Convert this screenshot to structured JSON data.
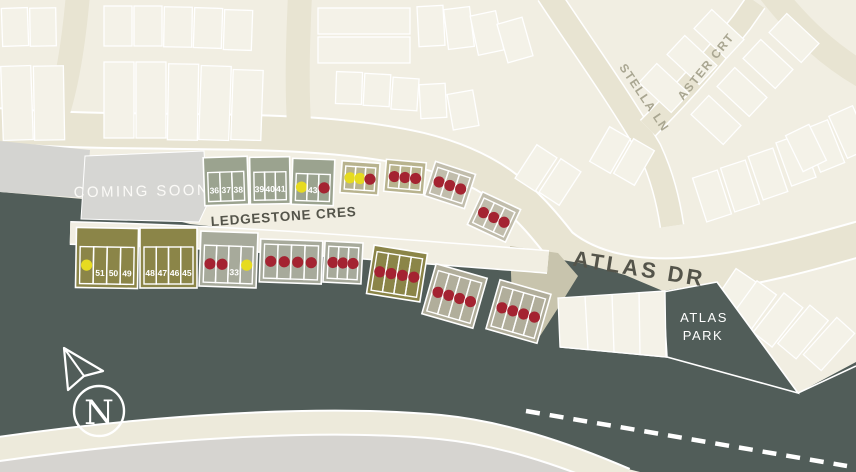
{
  "map": {
    "coming_soon_label": "COMING SOON",
    "streets": {
      "ledgestone": "LEDGESTONE CRES",
      "atlas_dr": "ATLAS DR",
      "stella_ln": "STELLA LN",
      "aster_crt": "ASTER CRT"
    },
    "park": {
      "line1": "ATLAS",
      "line2": "PARK"
    },
    "compass_label": "N",
    "status_colors": {
      "sold": "#a42331",
      "available": "#e6db21"
    },
    "palette": {
      "sage": "#9ba38f",
      "sage2": "#a7aa9b",
      "khaki": "#b8b38e",
      "graytan": "#c1bdac",
      "olive": "#8b8548",
      "sagetan": "#b1ae9b"
    },
    "blocks": [
      {
        "id": "lots-36-38",
        "fill": "sage",
        "x": 204,
        "y": 157,
        "w": 44,
        "h": 48,
        "rot": -2,
        "tp": 15,
        "lots": [
          {
            "num": "36"
          },
          {
            "num": "37"
          },
          {
            "num": "38"
          }
        ]
      },
      {
        "id": "lots-39-41",
        "fill": "sage",
        "x": 250,
        "y": 157,
        "w": 40,
        "h": 47,
        "rot": -1,
        "tp": 15,
        "lots": [
          {
            "num": "39"
          },
          {
            "num": "40"
          },
          {
            "num": "41"
          }
        ]
      },
      {
        "id": "lots-42-44",
        "fill": "sage",
        "x": 292,
        "y": 159,
        "w": 42,
        "h": 46,
        "rot": 2,
        "tp": 15,
        "lots": [
          {
            "status": "available"
          },
          {
            "num": "43"
          },
          {
            "status": "sold"
          }
        ]
      },
      {
        "id": "lots-row1-4",
        "fill": "khaki",
        "x": 341,
        "y": 162,
        "w": 38,
        "h": 32,
        "rot": 4,
        "tp": 5,
        "lots": [
          {
            "status": "available"
          },
          {
            "status": "available"
          },
          {
            "status": "sold"
          }
        ]
      },
      {
        "id": "lots-row1-5",
        "fill": "khaki",
        "x": 385,
        "y": 161,
        "w": 40,
        "h": 32,
        "rot": 5,
        "tp": 5,
        "lots": [
          {
            "status": "sold"
          },
          {
            "status": "sold"
          },
          {
            "status": "sold"
          }
        ]
      },
      {
        "id": "lots-row1-6",
        "fill": "graytan",
        "x": 429,
        "y": 167,
        "w": 42,
        "h": 36,
        "rot": 18,
        "tp": 5,
        "lots": [
          {
            "status": "sold"
          },
          {
            "status": "sold"
          },
          {
            "status": "sold"
          }
        ]
      },
      {
        "id": "lots-row1-7",
        "fill": "graytan",
        "x": 473,
        "y": 199,
        "w": 42,
        "h": 36,
        "rot": 25,
        "tp": 5,
        "lots": [
          {
            "status": "sold"
          },
          {
            "status": "sold"
          },
          {
            "status": "sold"
          }
        ]
      },
      {
        "id": "lots-49-51",
        "fill": "olive",
        "x": 76,
        "y": 228,
        "w": 62,
        "h": 60,
        "rot": 1,
        "tp": 19,
        "lots": [
          {
            "status": "available"
          },
          {
            "num": "51"
          },
          {
            "num": "50"
          },
          {
            "num": "49"
          }
        ]
      },
      {
        "id": "lots-45-48",
        "fill": "olive",
        "x": 140,
        "y": 228,
        "w": 57,
        "h": 60,
        "rot": 0,
        "tp": 19,
        "lots": [
          {
            "num": "48"
          },
          {
            "num": "47"
          },
          {
            "num": "46"
          },
          {
            "num": "45"
          }
        ]
      },
      {
        "id": "lots-33",
        "fill": "sage2",
        "x": 200,
        "y": 232,
        "w": 57,
        "h": 55,
        "rot": 2,
        "tp": 14,
        "lots": [
          {
            "status": "sold"
          },
          {
            "status": "sold"
          },
          {
            "num": "33"
          },
          {
            "status": "available"
          }
        ]
      },
      {
        "id": "lots-row2-4",
        "fill": "sage2",
        "x": 260,
        "y": 240,
        "w": 62,
        "h": 43,
        "rot": 2,
        "tp": 5,
        "lots": [
          {
            "status": "sold"
          },
          {
            "status": "sold"
          },
          {
            "status": "sold"
          },
          {
            "status": "sold"
          }
        ]
      },
      {
        "id": "lots-row2-5",
        "fill": "sage2",
        "x": 324,
        "y": 242,
        "w": 38,
        "h": 41,
        "rot": 3,
        "tp": 5,
        "lots": [
          {
            "status": "sold"
          },
          {
            "status": "sold"
          },
          {
            "status": "sold"
          }
        ]
      },
      {
        "id": "lots-row2-6",
        "fill": "olive",
        "x": 370,
        "y": 249,
        "w": 54,
        "h": 49,
        "rot": 9,
        "tp": 6,
        "lots": [
          {
            "status": "sold"
          },
          {
            "status": "sold"
          },
          {
            "status": "sold"
          },
          {
            "status": "sold"
          }
        ]
      },
      {
        "id": "lots-row2-7",
        "fill": "sagetan",
        "x": 428,
        "y": 270,
        "w": 53,
        "h": 52,
        "rot": 16,
        "tp": 6,
        "lots": [
          {
            "status": "sold"
          },
          {
            "status": "sold"
          },
          {
            "status": "sold"
          },
          {
            "status": "sold"
          }
        ]
      },
      {
        "id": "lots-row2-8",
        "fill": "sagetan",
        "x": 492,
        "y": 286,
        "w": 53,
        "h": 51,
        "rot": 16,
        "tp": 6,
        "lots": [
          {
            "status": "sold"
          },
          {
            "status": "sold"
          },
          {
            "status": "sold"
          },
          {
            "status": "sold"
          }
        ]
      }
    ]
  }
}
